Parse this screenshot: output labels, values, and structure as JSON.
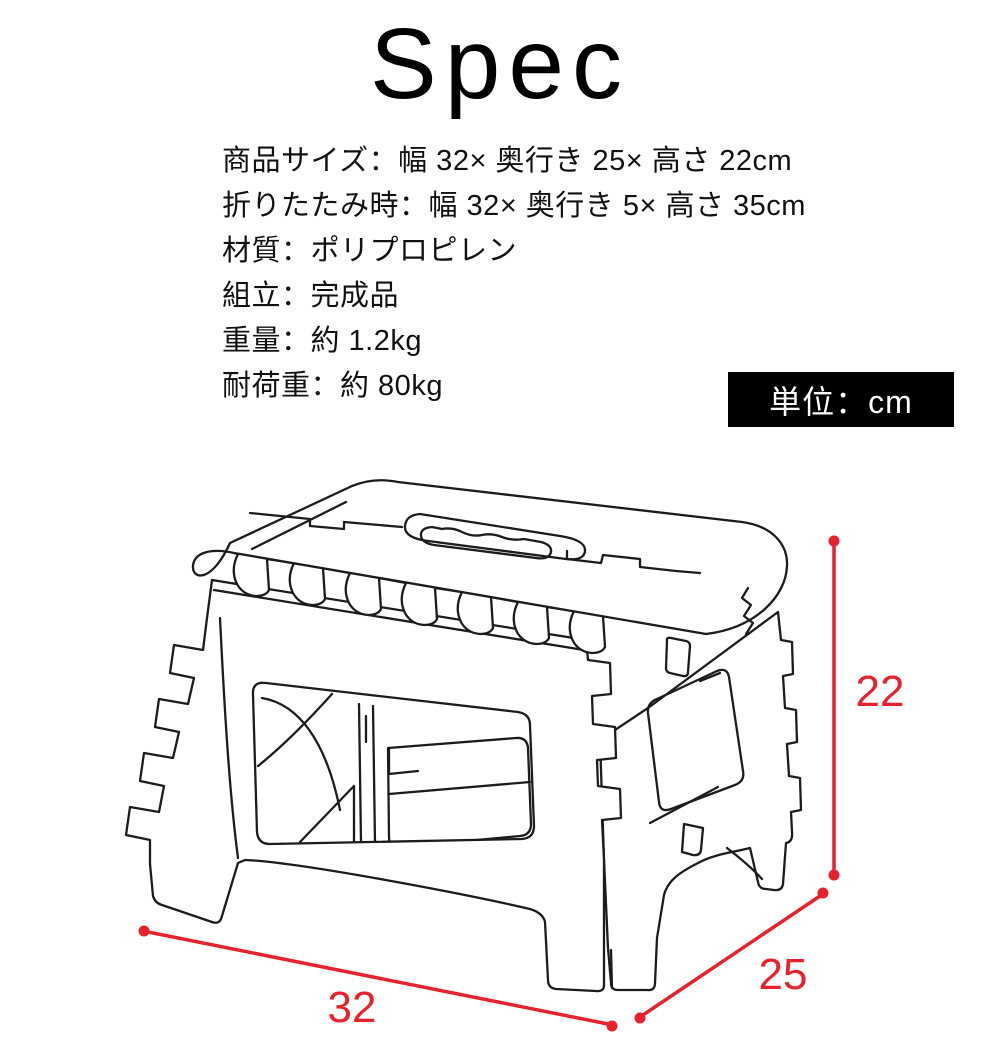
{
  "title": "Spec",
  "spec_list": {
    "lines": [
      "商品サイズ：幅 32× 奥行き 25× 高さ 22cm",
      "折りたたみ時：幅 32× 奥行き 5× 高さ 35cm",
      "材質：ポリプロピレン",
      "組立：完成品",
      "重量：約 1.2kg",
      "耐荷重：約 80kg"
    ]
  },
  "unit_badge": {
    "label": "単位：cm"
  },
  "diagram": {
    "dimension_labels": {
      "height_cm": "22",
      "width_cm": "32",
      "depth_cm": "25"
    },
    "colors": {
      "dimension_red": "#e7222c",
      "line_black": "#1c1c1c",
      "badge_background": "#000000",
      "badge_text": "#ffffff"
    }
  }
}
